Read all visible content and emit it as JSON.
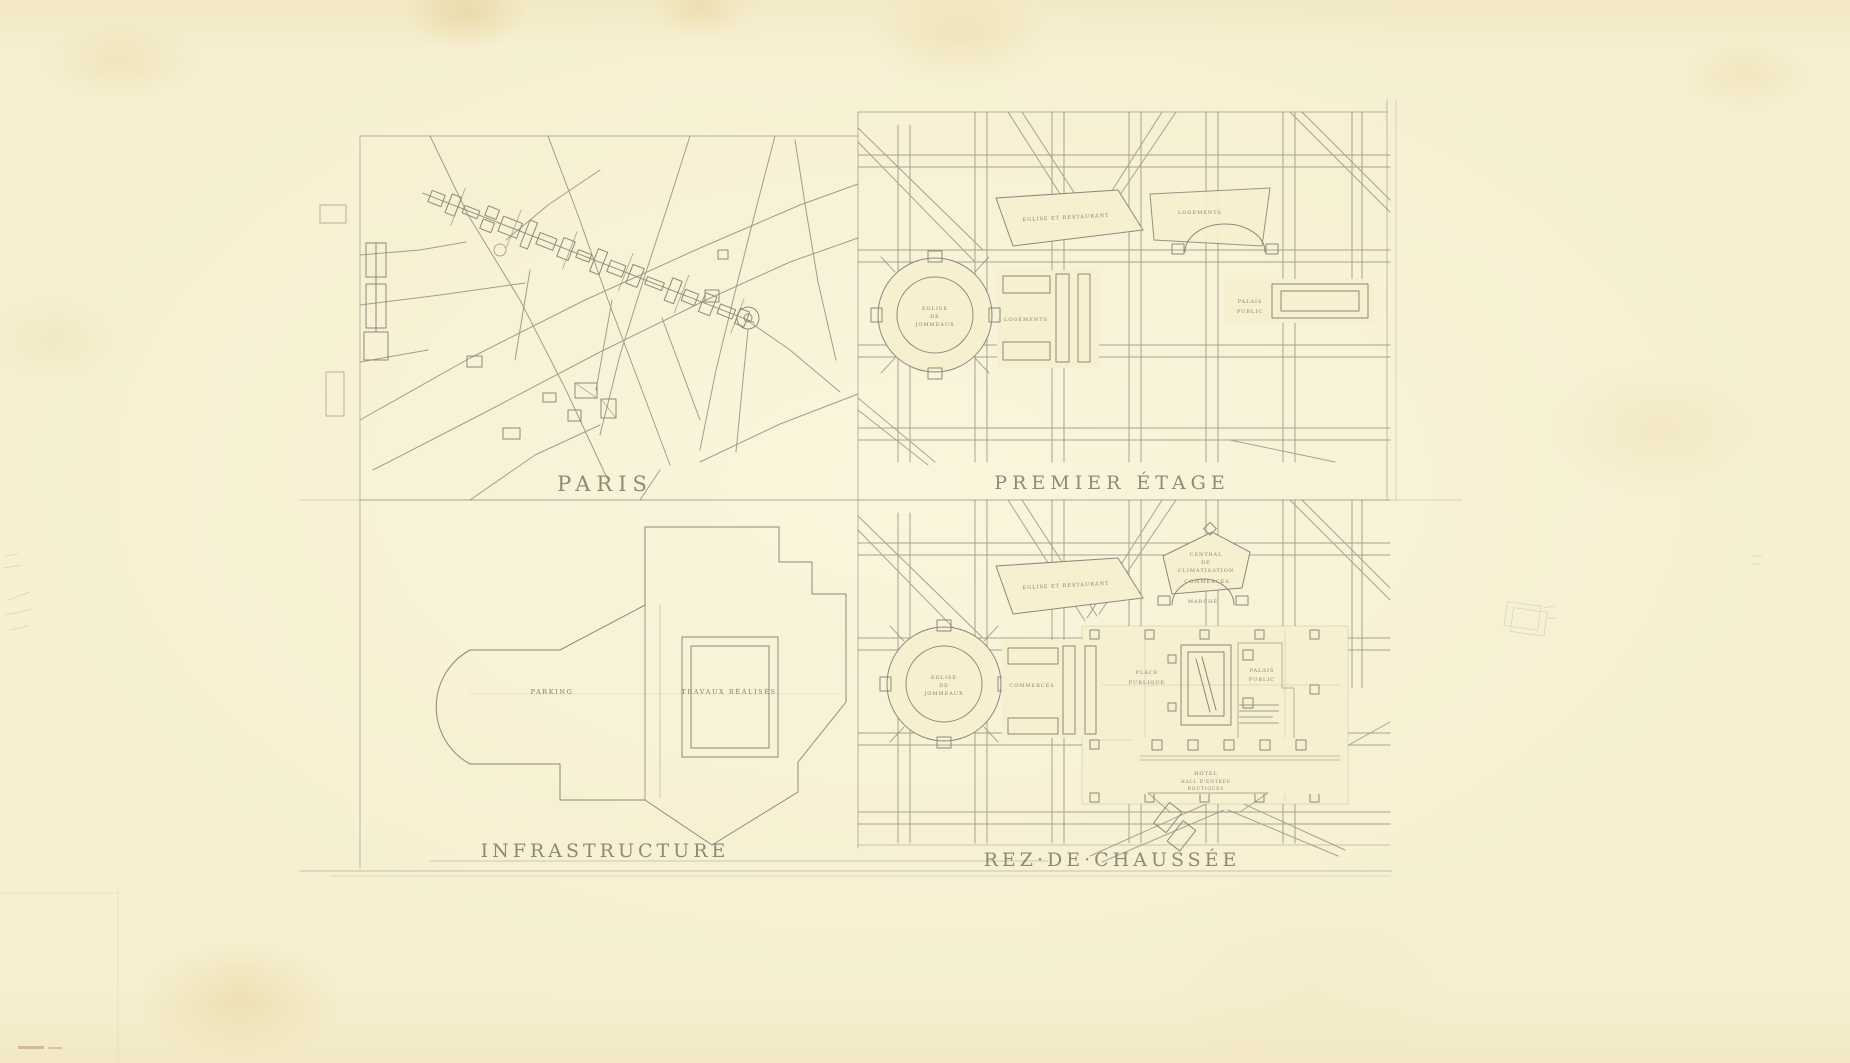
{
  "colors": {
    "paper": "#f6efd0",
    "ink": "#8b897c",
    "text": "#6f6d5f",
    "stamp": "#ab8a72"
  },
  "panels": {
    "paris": {
      "title": "PARIS"
    },
    "premier_etage": {
      "title": "PREMIER ÉTAGE",
      "labels": {
        "eglise_restaurant": "EGLISE ET RESTAURANT",
        "logements_nord": "LOGEMENTS",
        "logements_centre": "LOGEMENTS",
        "church": {
          "l1": "EGLISE",
          "l2": "DE",
          "l3": "JOMMEAUX"
        },
        "palais": {
          "l1": "PALAIS",
          "l2": "PUBLIC"
        }
      }
    },
    "infrastructure": {
      "title": "INFRASTRUCTURE",
      "labels": {
        "parking": "PARKING",
        "travaux": "TRAVAUX RÉALISÉS"
      }
    },
    "rez_de_chaussee": {
      "title": "REZ·DE·CHAUSSÉE",
      "labels": {
        "eglise_restaurant": "EGLISE ET RESTAURANT",
        "central": {
          "l1": "CENTRAL",
          "l2": "DE",
          "l3": "CLIMATISATION"
        },
        "commerces_nord": "COMMERCES",
        "marche": "MARCHÉ",
        "church": {
          "l1": "EGLISE",
          "l2": "DE",
          "l3": "JOMMEAUX"
        },
        "commerces_centre": "COMMERCES",
        "place": {
          "l1": "PLACE",
          "l2": "PUBLIQUE"
        },
        "palais": {
          "l1": "PALAIS",
          "l2": "PUBLIC"
        },
        "hotel": {
          "l1": "HOTEL",
          "l2": "HALL D'ENTRÉE",
          "l3": "BOUTIQUES"
        }
      }
    }
  }
}
